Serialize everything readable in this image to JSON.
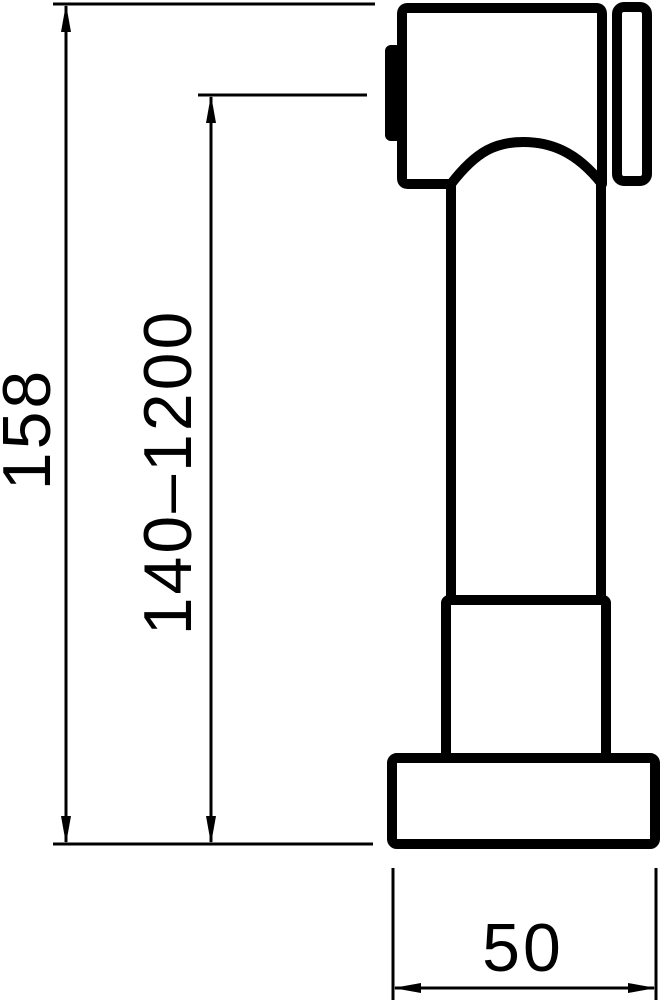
{
  "drawing": {
    "kind": "technical-dimension-drawing",
    "subject": "hand-shower-side-view",
    "background_color": "#ffffff",
    "line_color": "#000000",
    "dimensions": {
      "overall_height": {
        "label": "158",
        "orientation": "vertical"
      },
      "mounting_range": {
        "label": "140–1200",
        "orientation": "vertical"
      },
      "base_width": {
        "label": "50",
        "orientation": "horizontal"
      }
    },
    "parts": [
      {
        "name": "spray-head"
      },
      {
        "name": "spray-button"
      },
      {
        "name": "wall-bracket-plate"
      },
      {
        "name": "handle"
      },
      {
        "name": "mounting-sleeve"
      },
      {
        "name": "base-flange"
      }
    ]
  }
}
